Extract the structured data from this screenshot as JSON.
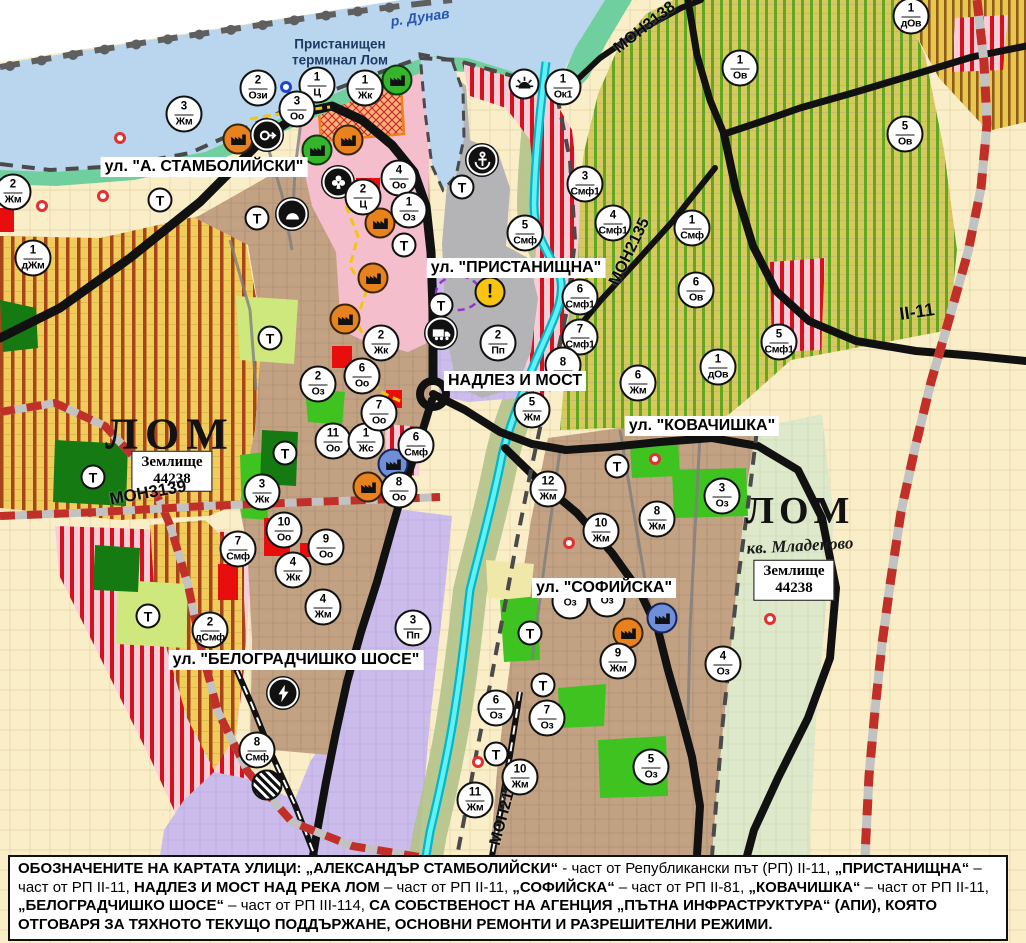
{
  "palette": {
    "water": "#b9d6ee",
    "shore": "#6fcf9f",
    "port_gray": "#b4b4b6",
    "city_tan": "#c3a284",
    "agri_yellow": "#f0cd5a",
    "agri_stripe": "#a8431a",
    "vine_bg": "#d6c960",
    "vine_stripe": "#61a81f",
    "smf_bg": "#f7cdd8",
    "smf_stripe": "#d2121f",
    "industrial_purple": "#cbbceb",
    "farm_beige": "#f9eec8",
    "park_green": "#3ec321",
    "river_cyan": "#35dde8",
    "road_black": "#111111",
    "rail_red": "#c03028"
  },
  "street_labels": [
    {
      "text": "ул. \"А. СТАМБОЛИЙСКИ\"",
      "x": 204,
      "y": 167
    },
    {
      "text": "ул. \"ПРИСТАНИЩНА\"",
      "x": 516,
      "y": 268
    },
    {
      "text": "НАДЛЕЗ И МОСТ",
      "x": 515,
      "y": 381
    },
    {
      "text": "ул. \"КОВАЧИШКА\"",
      "x": 702,
      "y": 426
    },
    {
      "text": "ул. \"СОФИЙСКА\"",
      "x": 604,
      "y": 588
    },
    {
      "text": "ул. \"БЕЛОГРАДЧИШКО ШОСЕ\"",
      "x": 296,
      "y": 660
    }
  ],
  "road_labels": [
    {
      "text": "МОН3138",
      "x": 645,
      "y": 28,
      "rot": -38,
      "size": 16
    },
    {
      "text": "МОН2135",
      "x": 630,
      "y": 252,
      "rot": -64,
      "size": 16
    },
    {
      "text": "МОН3139",
      "x": 148,
      "y": 493,
      "rot": -10,
      "size": 17
    },
    {
      "text": "МОН2136",
      "x": 505,
      "y": 810,
      "rot": -75,
      "size": 16
    },
    {
      "text": "II-11",
      "x": 917,
      "y": 312,
      "rot": -8,
      "size": 18
    }
  ],
  "place_labels": [
    {
      "text": "р. Дунав",
      "x": 420,
      "y": 17,
      "rot": -8,
      "kind": "river"
    },
    {
      "text": "Пристанищен\nтерминал Лом",
      "x": 340,
      "y": 52,
      "rot": 0,
      "kind": "terminal"
    },
    {
      "text": "ЛОМ",
      "x": 170,
      "y": 434,
      "rot": 0,
      "kind": "city",
      "size": 44,
      "ls": 7
    },
    {
      "text": "ЛОМ",
      "x": 800,
      "y": 511,
      "rot": 0,
      "kind": "city",
      "size": 38,
      "ls": 5
    },
    {
      "text": "кв. Младеново",
      "x": 800,
      "y": 546,
      "rot": -3,
      "kind": "quarter",
      "size": 17
    },
    {
      "text": "Землище\n44238",
      "x": 172,
      "y": 471,
      "rot": 0,
      "kind": "box"
    },
    {
      "text": "Землище\n44238",
      "x": 794,
      "y": 580,
      "rot": 0,
      "kind": "box"
    }
  ],
  "zone_markers": [
    {
      "num": "2",
      "code": "Ози",
      "x": 258,
      "y": 88
    },
    {
      "num": "1",
      "code": "Ц",
      "x": 317,
      "y": 85
    },
    {
      "num": "1",
      "code": "Жк",
      "x": 365,
      "y": 88
    },
    {
      "num": "3",
      "code": "Оо",
      "x": 297,
      "y": 109
    },
    {
      "num": "3",
      "code": "Жм",
      "x": 184,
      "y": 114
    },
    {
      "num": "2",
      "code": "Жм",
      "x": 13,
      "y": 192
    },
    {
      "num": "1",
      "code": "дЖм",
      "x": 33,
      "y": 258
    },
    {
      "num": "4",
      "code": "Оо",
      "x": 399,
      "y": 178
    },
    {
      "num": "2",
      "code": "Ц",
      "x": 363,
      "y": 197
    },
    {
      "num": "1",
      "code": "Оз",
      "x": 409,
      "y": 210
    },
    {
      "num": "2",
      "code": "Жк",
      "x": 381,
      "y": 343
    },
    {
      "num": "1",
      "code": "Ок1",
      "x": 563,
      "y": 87
    },
    {
      "num": "3",
      "code": "Смф1",
      "x": 585,
      "y": 184
    },
    {
      "num": "5",
      "code": "Смф",
      "x": 525,
      "y": 233
    },
    {
      "num": "4",
      "code": "Смф1",
      "x": 613,
      "y": 223
    },
    {
      "num": "1",
      "code": "Смф",
      "x": 692,
      "y": 228
    },
    {
      "num": "1",
      "code": "Ов",
      "x": 740,
      "y": 68
    },
    {
      "num": "5",
      "code": "Ов",
      "x": 905,
      "y": 134
    },
    {
      "num": "1",
      "code": "дОв",
      "x": 911,
      "y": 16
    },
    {
      "num": "6",
      "code": "Ов",
      "x": 696,
      "y": 290
    },
    {
      "num": "1",
      "code": "дОв",
      "x": 718,
      "y": 367
    },
    {
      "num": "5",
      "code": "Смф1",
      "x": 779,
      "y": 342
    },
    {
      "num": "6",
      "code": "Смф1",
      "x": 580,
      "y": 297
    },
    {
      "num": "7",
      "code": "Смф1",
      "x": 580,
      "y": 337
    },
    {
      "num": "2",
      "code": "Пп",
      "x": 498,
      "y": 343
    },
    {
      "num": "8",
      "code": "",
      "x": 563,
      "y": 365
    },
    {
      "num": "5",
      "code": "Жм",
      "x": 532,
      "y": 410
    },
    {
      "num": "6",
      "code": "Жм",
      "x": 638,
      "y": 383
    },
    {
      "num": "12",
      "code": "Жм",
      "x": 548,
      "y": 489
    },
    {
      "num": "10",
      "code": "Жм",
      "x": 601,
      "y": 531
    },
    {
      "num": "8",
      "code": "Жм",
      "x": 657,
      "y": 519
    },
    {
      "num": "3",
      "code": "Оз",
      "x": 722,
      "y": 496
    },
    {
      "num": "9",
      "code": "Жм",
      "x": 618,
      "y": 661
    },
    {
      "num": "4",
      "code": "Оз",
      "x": 723,
      "y": 664
    },
    {
      "num": "",
      "code": "Оз",
      "x": 570,
      "y": 601
    },
    {
      "num": "",
      "code": "Оз",
      "x": 607,
      "y": 599
    },
    {
      "num": "6",
      "code": "Оз",
      "x": 496,
      "y": 708
    },
    {
      "num": "7",
      "code": "Оз",
      "x": 547,
      "y": 718
    },
    {
      "num": "10",
      "code": "Жм",
      "x": 520,
      "y": 777
    },
    {
      "num": "11",
      "code": "Жм",
      "x": 475,
      "y": 800
    },
    {
      "num": "5",
      "code": "Оз",
      "x": 651,
      "y": 767
    },
    {
      "num": "3",
      "code": "Пп",
      "x": 413,
      "y": 628
    },
    {
      "num": "10",
      "code": "Оо",
      "x": 284,
      "y": 530
    },
    {
      "num": "9",
      "code": "Оо",
      "x": 326,
      "y": 547
    },
    {
      "num": "4",
      "code": "Жк",
      "x": 293,
      "y": 570
    },
    {
      "num": "4",
      "code": "Жм",
      "x": 323,
      "y": 607
    },
    {
      "num": "7",
      "code": "Смф",
      "x": 238,
      "y": 549
    },
    {
      "num": "2",
      "code": "дСмф",
      "x": 210,
      "y": 630
    },
    {
      "num": "8",
      "code": "Смф",
      "x": 257,
      "y": 750
    },
    {
      "num": "3",
      "code": "Жк",
      "x": 262,
      "y": 492
    },
    {
      "num": "11",
      "code": "Оо",
      "x": 333,
      "y": 441
    },
    {
      "num": "1",
      "code": "Жс",
      "x": 366,
      "y": 441
    },
    {
      "num": "6",
      "code": "Смф",
      "x": 416,
      "y": 445
    },
    {
      "num": "8",
      "code": "Оо",
      "x": 399,
      "y": 490
    },
    {
      "num": "2",
      "code": "Оз",
      "x": 318,
      "y": 384
    },
    {
      "num": "6",
      "code": "Оо",
      "x": 362,
      "y": 376
    },
    {
      "num": "7",
      "code": "Оо",
      "x": 379,
      "y": 413
    }
  ],
  "t_markers": [
    {
      "x": 160,
      "y": 200
    },
    {
      "x": 257,
      "y": 218
    },
    {
      "x": 270,
      "y": 338
    },
    {
      "x": 404,
      "y": 245
    },
    {
      "x": 462,
      "y": 187
    },
    {
      "x": 441,
      "y": 305
    },
    {
      "x": 93,
      "y": 477
    },
    {
      "x": 285,
      "y": 453
    },
    {
      "x": 148,
      "y": 616
    },
    {
      "x": 617,
      "y": 466
    },
    {
      "x": 530,
      "y": 633
    },
    {
      "x": 543,
      "y": 685
    },
    {
      "x": 496,
      "y": 754
    }
  ],
  "icons": [
    {
      "type": "factory",
      "color": "orange",
      "x": 238,
      "y": 139
    },
    {
      "type": "factory",
      "color": "orange",
      "x": 348,
      "y": 140
    },
    {
      "type": "factory",
      "color": "orange",
      "x": 380,
      "y": 223
    },
    {
      "type": "factory",
      "color": "orange",
      "x": 373,
      "y": 278
    },
    {
      "type": "factory",
      "color": "orange",
      "x": 345,
      "y": 319
    },
    {
      "type": "factory",
      "color": "orange",
      "x": 368,
      "y": 487
    },
    {
      "type": "factory",
      "color": "orange",
      "x": 628,
      "y": 633
    },
    {
      "type": "factory",
      "color": "green",
      "x": 317,
      "y": 150
    },
    {
      "type": "factory",
      "color": "green",
      "x": 397,
      "y": 80
    },
    {
      "type": "factory",
      "color": "blue",
      "x": 393,
      "y": 464
    },
    {
      "type": "factory",
      "color": "blue",
      "x": 662,
      "y": 618
    },
    {
      "type": "anchor",
      "x": 482,
      "y": 160
    },
    {
      "type": "sun",
      "x": 524,
      "y": 84
    },
    {
      "type": "club",
      "x": 338,
      "y": 182
    },
    {
      "type": "arch",
      "x": 292,
      "y": 214
    },
    {
      "type": "arrow",
      "x": 267,
      "y": 135
    },
    {
      "type": "warning",
      "x": 490,
      "y": 292
    },
    {
      "type": "truck",
      "x": 441,
      "y": 333
    },
    {
      "type": "lightning",
      "x": 283,
      "y": 693
    },
    {
      "type": "crossing",
      "x": 267,
      "y": 785
    }
  ],
  "dots": [
    {
      "x": 120,
      "y": 138,
      "color": "red"
    },
    {
      "x": 103,
      "y": 196,
      "color": "red"
    },
    {
      "x": 42,
      "y": 206,
      "color": "red"
    },
    {
      "x": 655,
      "y": 459,
      "color": "red"
    },
    {
      "x": 569,
      "y": 543,
      "color": "red"
    },
    {
      "x": 478,
      "y": 762,
      "color": "red"
    },
    {
      "x": 770,
      "y": 619,
      "color": "red"
    },
    {
      "x": 286,
      "y": 87,
      "color": "blue"
    }
  ],
  "note": {
    "segments": [
      {
        "t": "ОБОЗНАЧЕНИТЕ НА КАРТАТА УЛИЦИ: „АЛЕКСАНДЪР СТАМБОЛИЙСКИ“",
        "b": true
      },
      {
        "t": " - част от Републикански път (РП) II-11, ",
        "b": false
      },
      {
        "t": "„ПРИСТАНИЩНА“",
        "b": true
      },
      {
        "t": " – част от РП II-11, ",
        "b": false
      },
      {
        "t": "НАДЛЕЗ И МОСТ НАД РЕКА ЛОМ",
        "b": true
      },
      {
        "t": " – част от РП II-11, ",
        "b": false
      },
      {
        "t": "„СОФИЙСКА“",
        "b": true
      },
      {
        "t": " – част от РП II-81, ",
        "b": false
      },
      {
        "t": "„КОВАЧИШКА“",
        "b": true
      },
      {
        "t": " – част от РП II-11, ",
        "b": false
      },
      {
        "t": "„БЕЛОГРАДЧИШКО ШОСЕ“",
        "b": true
      },
      {
        "t": " – част от РП III-114, ",
        "b": false
      },
      {
        "t": "СА СОБСТВЕНОСТ НА АГЕНЦИЯ „ПЪТНА ИНФРАСТРУКТУРА“ (АПИ), КОЯТО ОТГОВАРЯ ЗА ТЯХНОТО ТЕКУЩО ПОДДЪРЖАНЕ, ОСНОВНИ РЕМОНТИ И РАЗРЕШИТЕЛНИ РЕЖИМИ.",
        "b": true
      }
    ]
  }
}
